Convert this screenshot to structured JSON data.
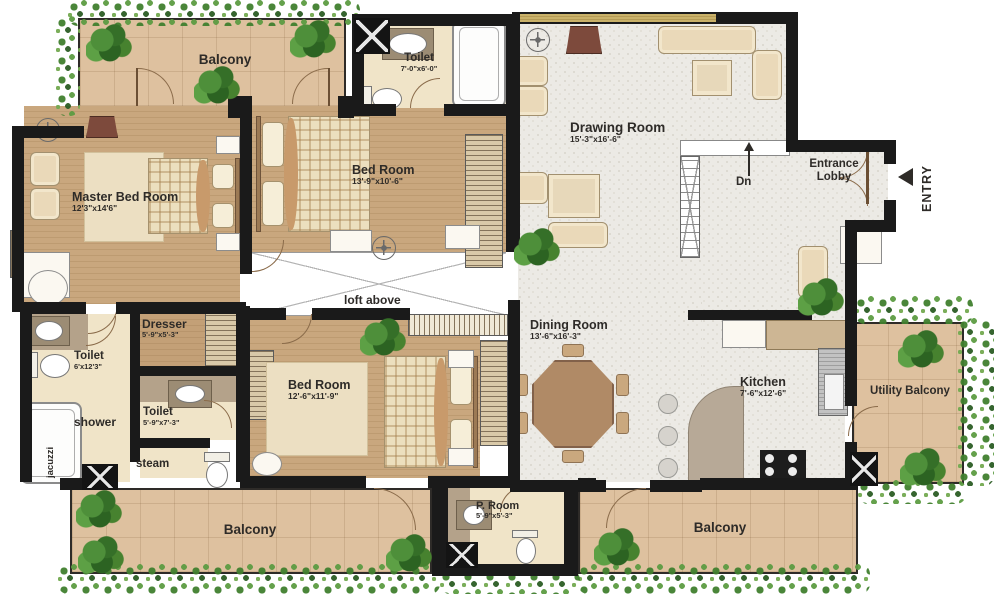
{
  "rooms": {
    "balcony_top": {
      "name": "Balcony"
    },
    "master_bedroom": {
      "name": "Master Bed Room",
      "dims": "12'3\"x14'6\""
    },
    "toilet_top": {
      "name": "Toilet",
      "dims": "7'-0\"x6'-0\""
    },
    "bedroom_top": {
      "name": "Bed Room",
      "dims": "13'-9\"x10'-6\""
    },
    "drawing_room": {
      "name": "Drawing Room",
      "dims": "15'-3\"x16'-6\""
    },
    "entrance_lobby": {
      "name": "Entrance Lobby"
    },
    "dresser": {
      "name": "Dresser",
      "dims": "5'-9\"x5'-3\""
    },
    "toilet_left": {
      "name": "Toilet",
      "dims": "6'x12'3\""
    },
    "toilet_mid": {
      "name": "Toilet",
      "dims": "5'-9\"x7'-3\""
    },
    "bedroom_bottom": {
      "name": "Bed Room",
      "dims": "12'-6\"x11'-9\""
    },
    "dining_room": {
      "name": "Dining Room",
      "dims": "13'-6\"x16'-3\""
    },
    "kitchen": {
      "name": "Kitchen",
      "dims": "7'-6\"x12'-6\""
    },
    "utility_balcony": {
      "name": "Utility Balcony"
    },
    "p_room": {
      "name": "P. Room",
      "dims": "5'-9\"x5'-3\""
    },
    "balcony_bottom_left": {
      "name": "Balcony"
    },
    "balcony_bottom_right": {
      "name": "Balcony"
    }
  },
  "annotations": {
    "loft": "loft above",
    "dn": "Dn",
    "entry": "ENTRY",
    "shower": "shower",
    "jacuzzi": "jacuzzi",
    "steam": "steam"
  },
  "icons": {
    "entry_arrow": "triangle-left",
    "dn_arrow": "arrow-up",
    "ceiling_fan": "circle-cross"
  },
  "colors": {
    "wall": "#1a1a1a",
    "wood_floor": "#c9a77e",
    "tile_floor": "#dec19f",
    "gray_floor": "#eceae5",
    "cream_floor": "#f0e4c8",
    "greenery": "#41802f",
    "label_text": "#2e2b28"
  }
}
